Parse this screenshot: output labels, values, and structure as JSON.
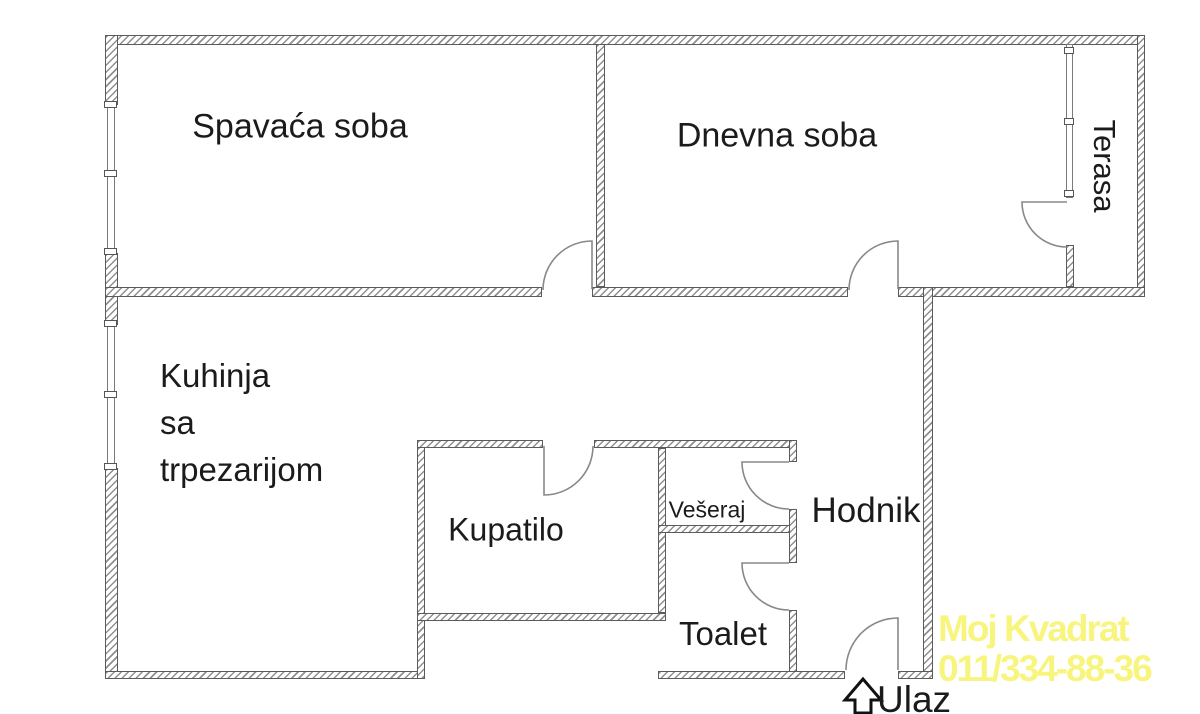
{
  "plan": {
    "rooms": {
      "bedroom": {
        "label": "Spavaća soba"
      },
      "living_room": {
        "label": "Dnevna soba"
      },
      "terrace": {
        "label": "Terasa"
      },
      "kitchen": {
        "label": "Kuhinja\nsa\ntrpezarijom"
      },
      "bathroom": {
        "label": "Kupatilo"
      },
      "laundry": {
        "label": "Vešeraj"
      },
      "toilet": {
        "label": "Toalet"
      },
      "hallway": {
        "label": "Hodnik"
      }
    },
    "entrance": {
      "label": "Ulaz",
      "arrow_icon": "up-arrow-icon"
    },
    "watermark": {
      "line1": "Moj Kvadrat",
      "line2": "011/334-88-36",
      "color": "#f8f57e"
    }
  }
}
